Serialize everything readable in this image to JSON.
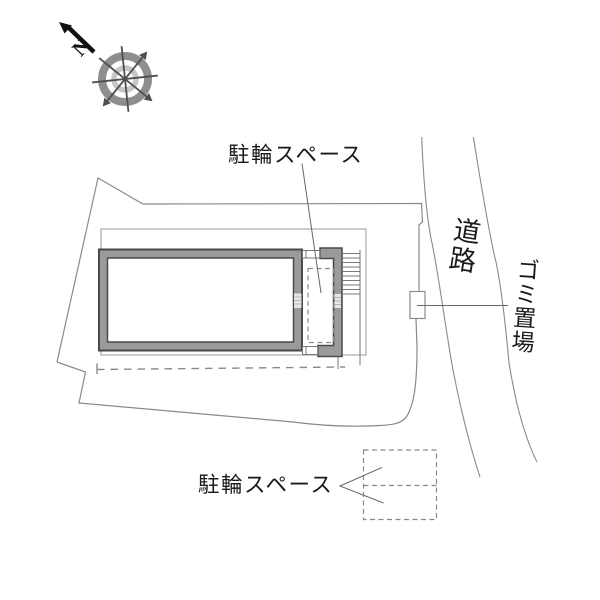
{
  "title": "建物配置図 (site layout plan)",
  "labels": {
    "bicycle_space_top": "駐輪スペース",
    "bicycle_space_bottom": "駐輪スペース",
    "road": "道路",
    "garbage_area": "ゴミ置場",
    "compass_north": "N"
  },
  "features": {
    "building": "1棟の建物(厚壁の矩形)と右側の階段・玄関ポーチ",
    "bicycle_parking_upper": "建物右側の破線矩形",
    "bicycle_parking_lower": "敷地南側の破線矩形(2列)",
    "garbage_box": "道路沿いの小矩形",
    "road": "敷地東側を斜めに走る2本線の道路",
    "compass": "8方位コンパス・北は左上方向"
  },
  "colors": {
    "background": "#ffffff",
    "boundary_line": "#8a8a8a",
    "road_line": "#8a8a8a",
    "wall_fill": "#9a9a9a",
    "wall_edge": "#4a4a4a",
    "thin_outline": "#9a9a9a",
    "dashed_line": "#8a8a8a",
    "leader_line": "#666666",
    "text": "#1a1a1a",
    "compass_ring_outer": "#8e8e8e",
    "compass_ring_inner": "#c6c6c6",
    "compass_spokes": "#4f4f4f",
    "north_arrow": "#111111"
  }
}
